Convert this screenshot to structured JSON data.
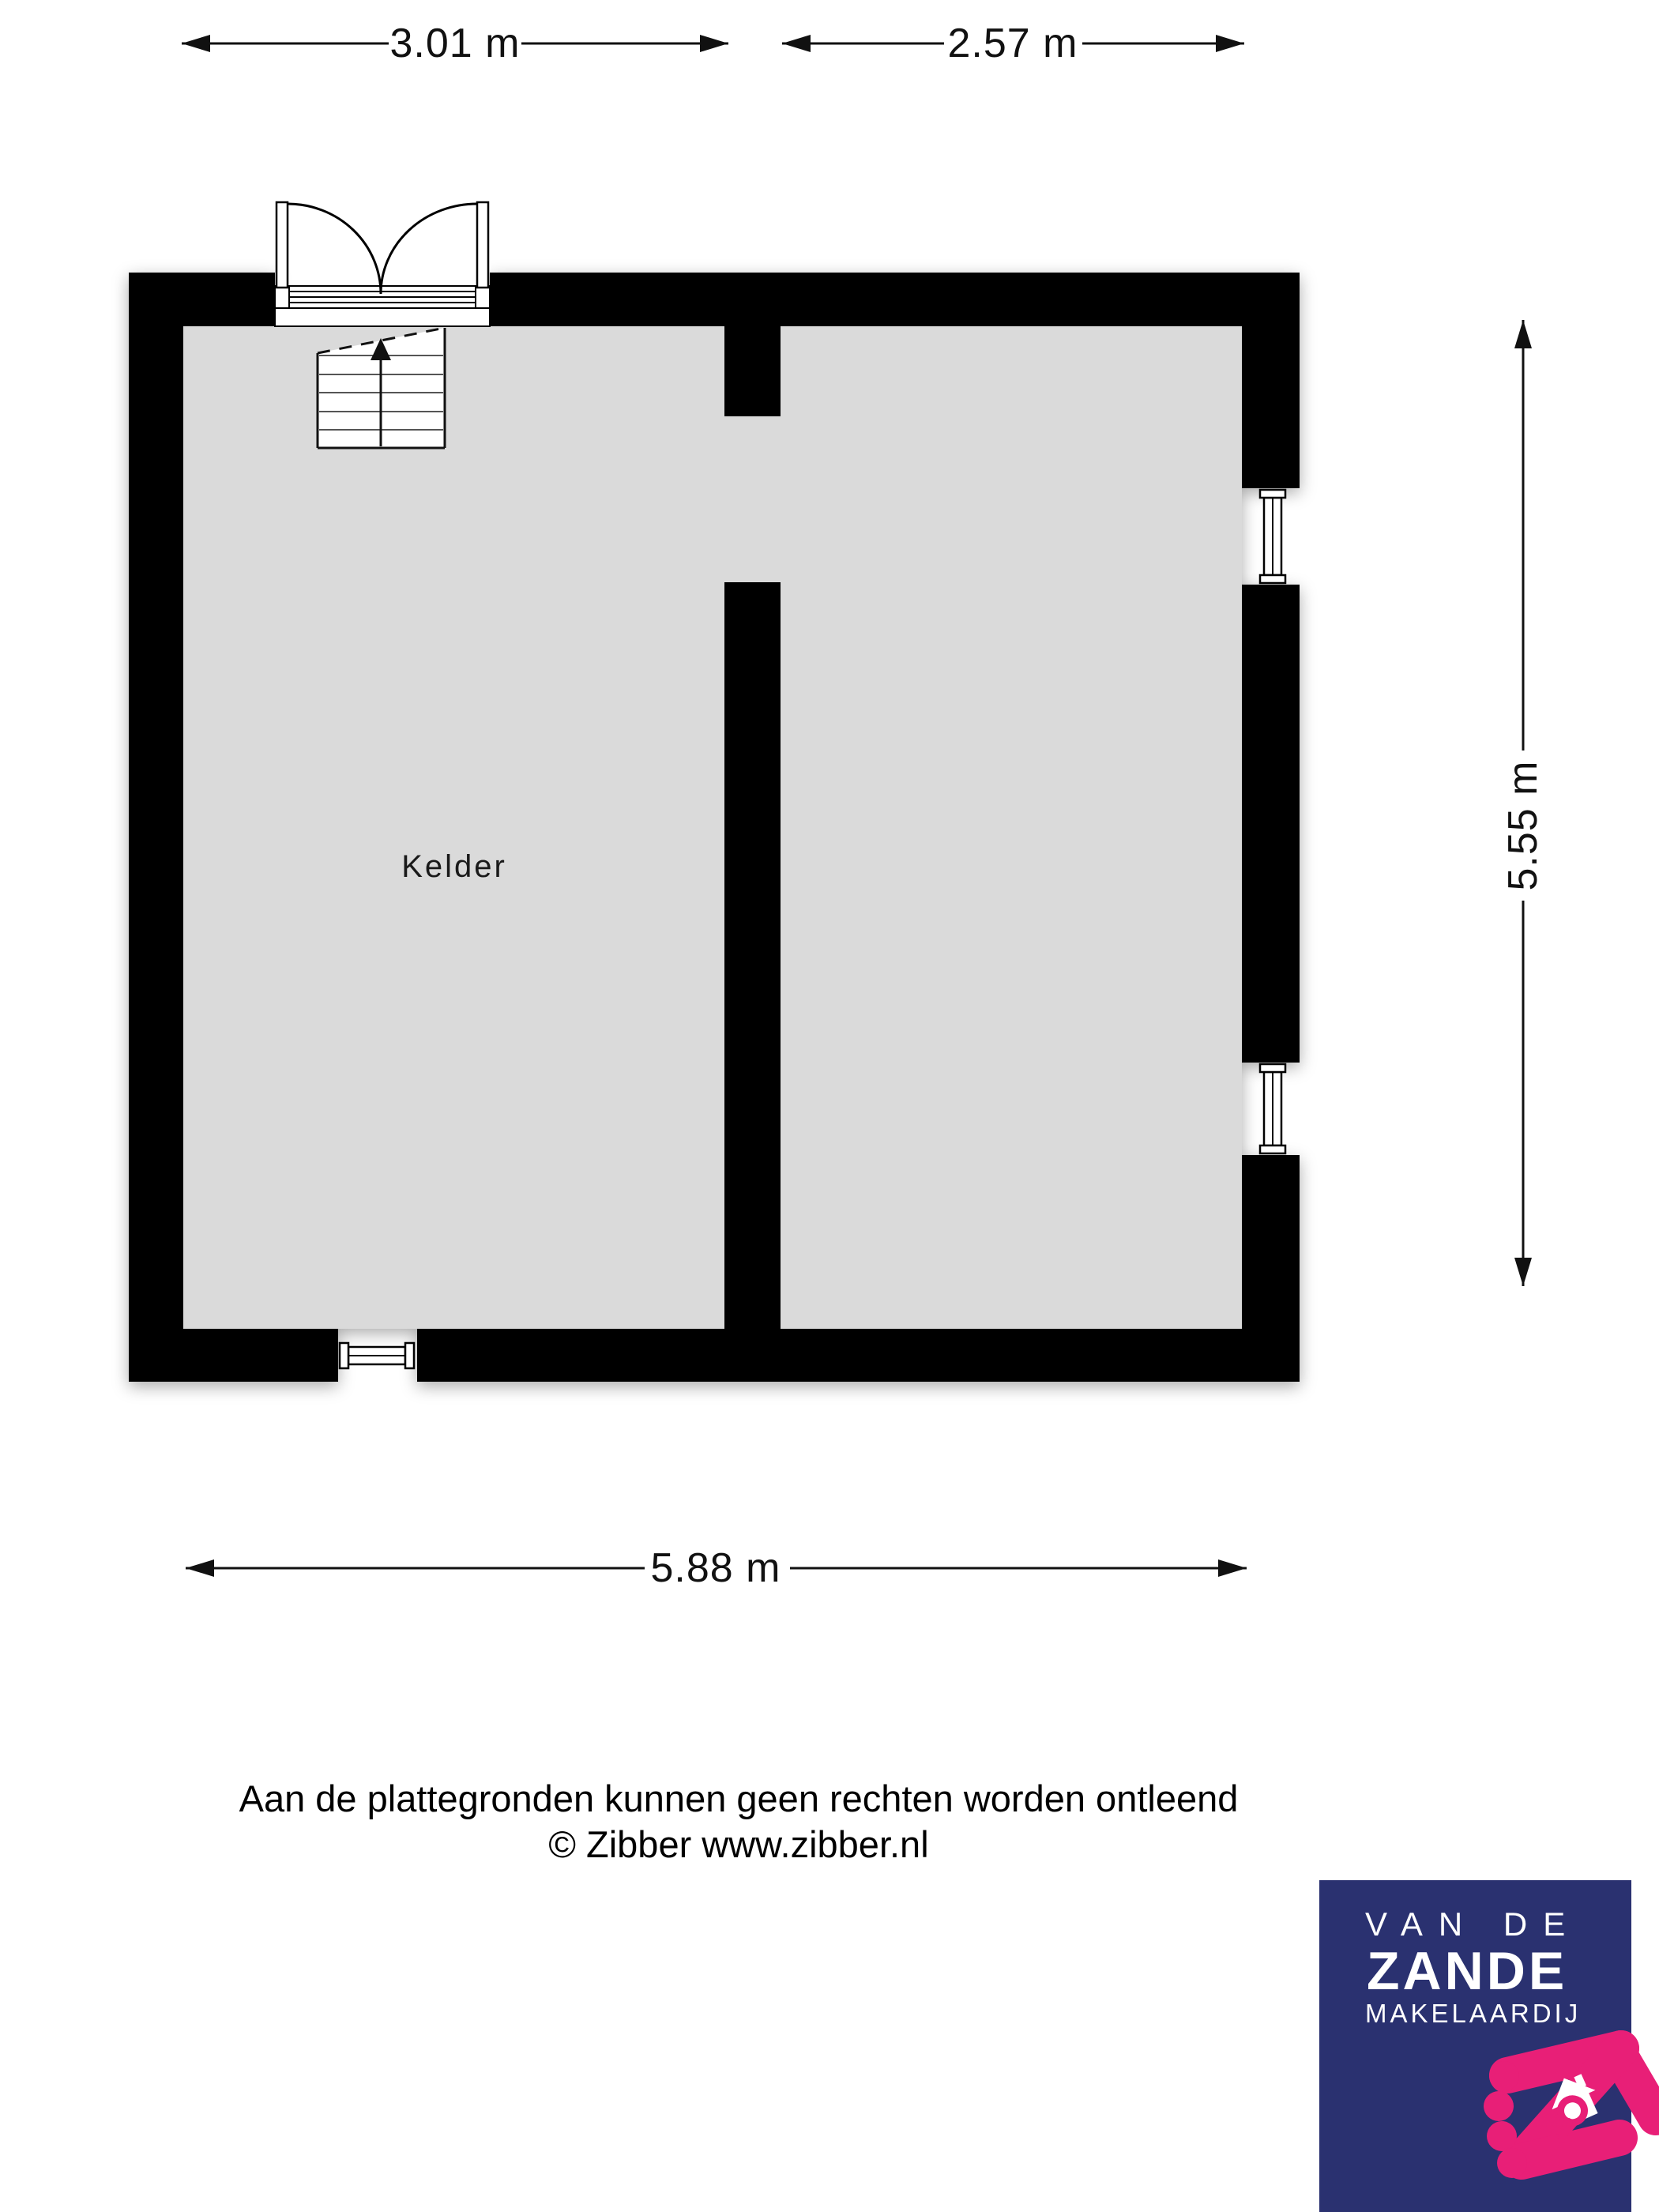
{
  "plan": {
    "room_label": "Kelder",
    "dimensions": {
      "top_left": "3.01 m",
      "top_right": "2.57 m",
      "right": "5.55 m",
      "bottom": "5.88 m"
    },
    "colors": {
      "wall": "#000000",
      "floor": "#dadada"
    }
  },
  "disclaimer": {
    "line1": "Aan de plattegronden kunnen geen rechten worden ontleend",
    "line2": "© Zibber www.zibber.nl"
  },
  "logo": {
    "line1": "VAN DE",
    "line2": "ZANDE",
    "line3": "MAKELAARDIJ",
    "colors": {
      "background": "#2a3170",
      "accent": "#e81f77",
      "text": "#ffffff"
    }
  }
}
